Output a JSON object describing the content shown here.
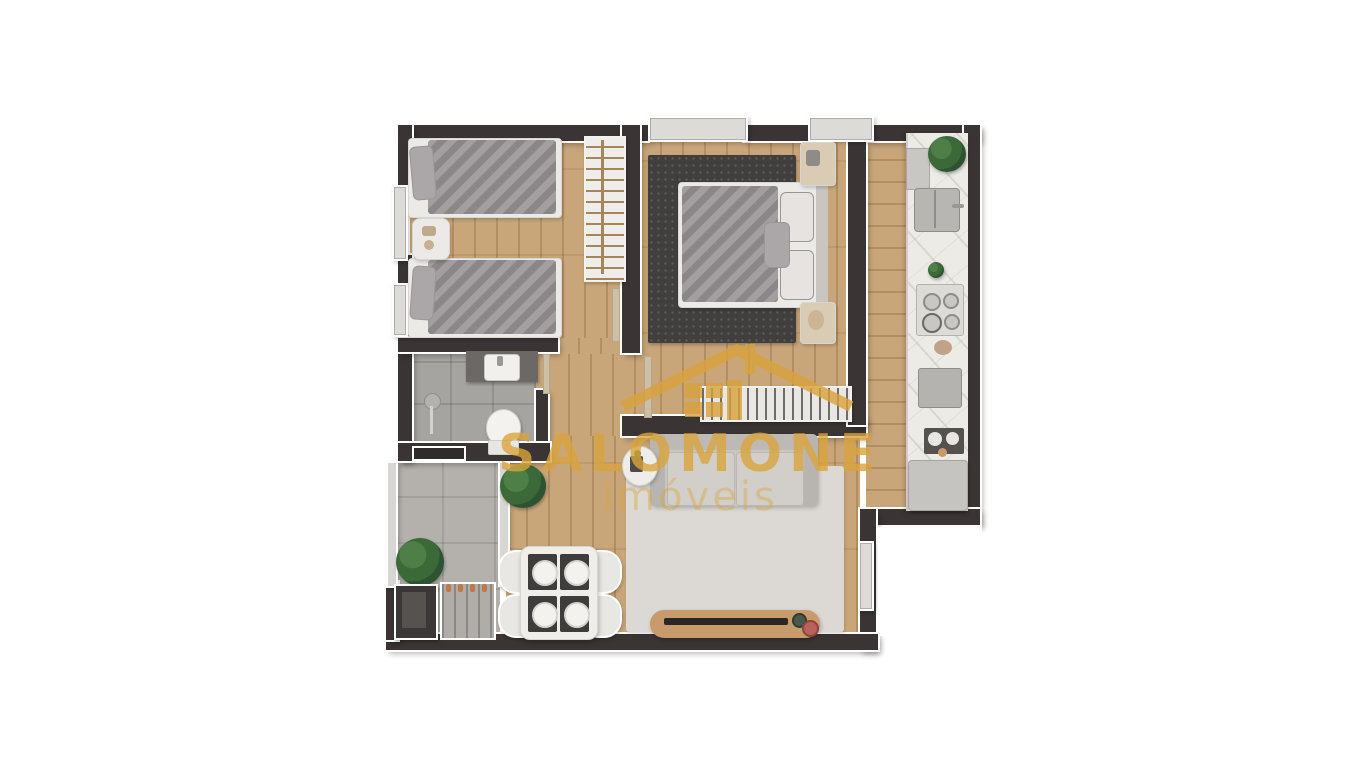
{
  "watermark": {
    "brand": "SALOMONE",
    "tagline": "imóveis",
    "gold": "#D9A23B"
  },
  "palette": {
    "background": "#FFFFFF",
    "wall": "#3A3534",
    "wall_trim": "#FFFFFF",
    "wood_floor": "#C9A67A",
    "wood_plank_line": "#B8905F",
    "bathroom_tile": "#A6A4A1",
    "terrace_tile": "#B4B1AD",
    "kitchen_counter_marble": "#EDEBE6",
    "master_rug": "#413F3D",
    "living_rug": "#DCD9D5",
    "sofa": "#C9C6C2",
    "bedding_gray": "#948F91",
    "plant_green": "#3C6938",
    "wood_furniture": "#C79B6B",
    "stainless": "#B8B6B2"
  },
  "floorplan": {
    "type": "apartment-top-view-render",
    "rooms": [
      {
        "name": "twin-bedroom",
        "furniture": [
          "single-bed",
          "single-bed",
          "nightstand",
          "wardrobe-with-hangers"
        ]
      },
      {
        "name": "master-bedroom",
        "furniture": [
          "double-bed",
          "dark-rug",
          "nightstand-top",
          "nightstand-bottom",
          "slatted-wardrobe"
        ]
      },
      {
        "name": "bathroom",
        "furniture": [
          "vanity-sink",
          "toilet",
          "toilet-brush-stand",
          "window-niche"
        ]
      },
      {
        "name": "kitchen",
        "furniture": [
          "marble-counter",
          "double-sink",
          "cooktop-4-burners",
          "oven",
          "coffee-tray",
          "refrigerator",
          "plant"
        ]
      },
      {
        "name": "living-room",
        "furniture": [
          "sofa",
          "round-side-table",
          "light-rug",
          "tv-bench",
          "tv",
          "corner-plant"
        ]
      },
      {
        "name": "dining-area",
        "furniture": [
          "dining-table",
          "chair",
          "chair",
          "chair",
          "chair",
          "place-setting-x4"
        ]
      },
      {
        "name": "terrace-laundry",
        "furniture": [
          "plant",
          "storage-shaft",
          "drying-rack",
          "glass-partition"
        ]
      }
    ]
  }
}
